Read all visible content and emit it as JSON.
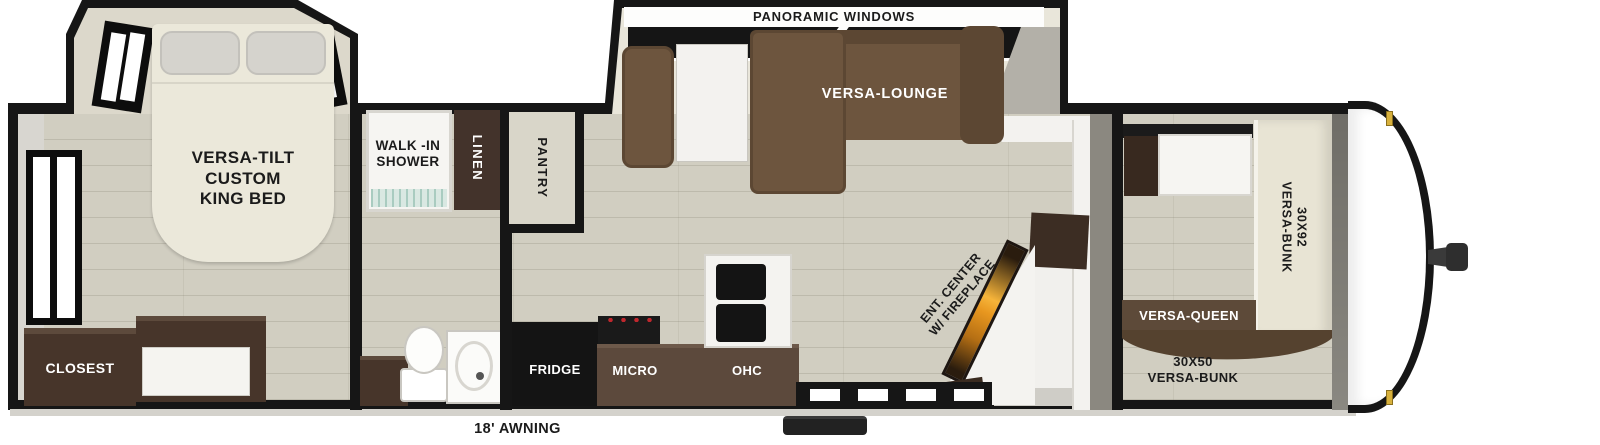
{
  "floorplan": {
    "slide_lounge": {
      "window_label": "PANORAMIC WINDOWS",
      "sofa_label": "VERSA-LOUNGE"
    },
    "bedroom": {
      "bed_label": "VERSA-TILT\nCUSTOM\nKING BED",
      "closet_label": "CLOSEST"
    },
    "bathroom": {
      "shower_label": "WALK -IN\nSHOWER",
      "linen_label": "LINEN"
    },
    "kitchen": {
      "pantry_label": "PANTRY",
      "fridge_label": "FRIDGE",
      "micro_label": "MICRO",
      "ohc_label": "OHC"
    },
    "living": {
      "ent_center_label": "ENT. CENTER\nW/ FIREPLACE"
    },
    "bunk_room": {
      "bunk_large_label": "30X92\nVERSA-BUNK",
      "queen_label": "VERSA-QUEEN",
      "bunk_small_label": "30X50\nVERSA-BUNK"
    },
    "exterior": {
      "awning_label": "18' AWNING"
    }
  },
  "colors": {
    "wall": "#161616",
    "floor": "#d1cec1",
    "slide-floor": "#e9e6da",
    "sofa": "#6d553e",
    "sofa-dark": "#5c4733",
    "cabinet": "#47352a",
    "counter": "#5c493c",
    "appliance": "#141414",
    "queen-band": "#5d4a39",
    "bunk-cream": "#e8e4d4",
    "fire-orange": "#e8971f",
    "gray-wall": "#8b8880",
    "marker-light": "#d8b13c"
  }
}
